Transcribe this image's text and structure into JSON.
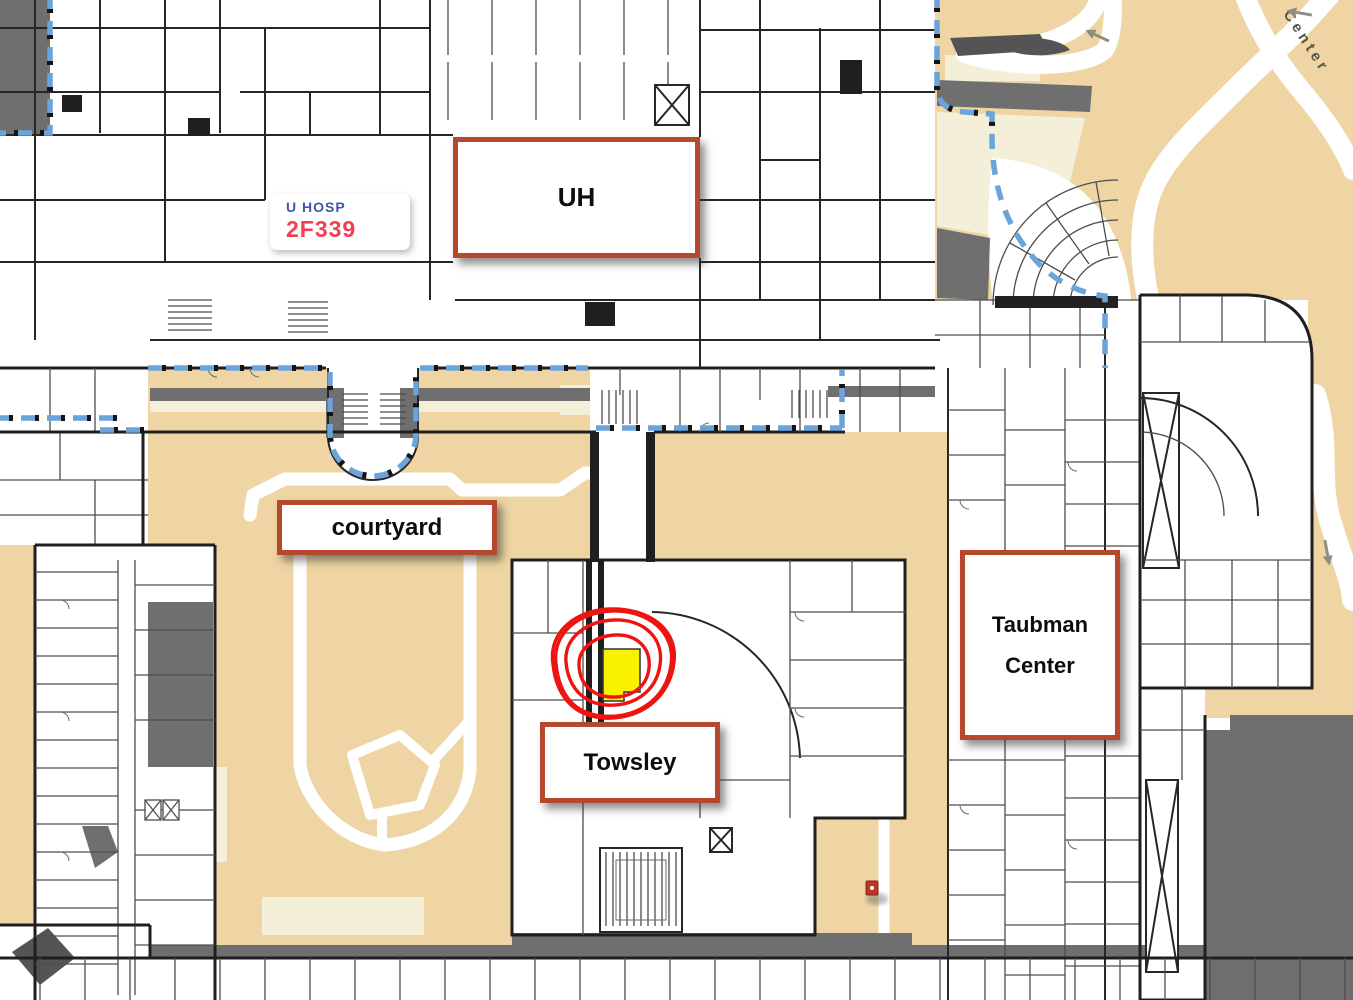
{
  "map": {
    "labels": {
      "uh": "UH",
      "courtyard": "courtyard",
      "towsley": "Towsley",
      "taubman_line1": "Taubman",
      "taubman_line2": "Center"
    },
    "room_callout": {
      "building": "U HOSP",
      "room": "2F339"
    },
    "street_label": "Center",
    "colors": {
      "tan": "#eed5a3",
      "cream": "#f4efd9",
      "gray": "#6f6f6f",
      "dark_gray": "#545454",
      "wall": "#1f1f1f",
      "boundary_blue": "#6ba4da",
      "label_border": "#b5492e",
      "highlight_yellow": "#f8f200",
      "annotation_red": "#ee1411",
      "callout_room": "#f63e52",
      "callout_bldg": "#4355a8",
      "marker_red": "#bb3629",
      "street_text": "#55544a"
    }
  }
}
